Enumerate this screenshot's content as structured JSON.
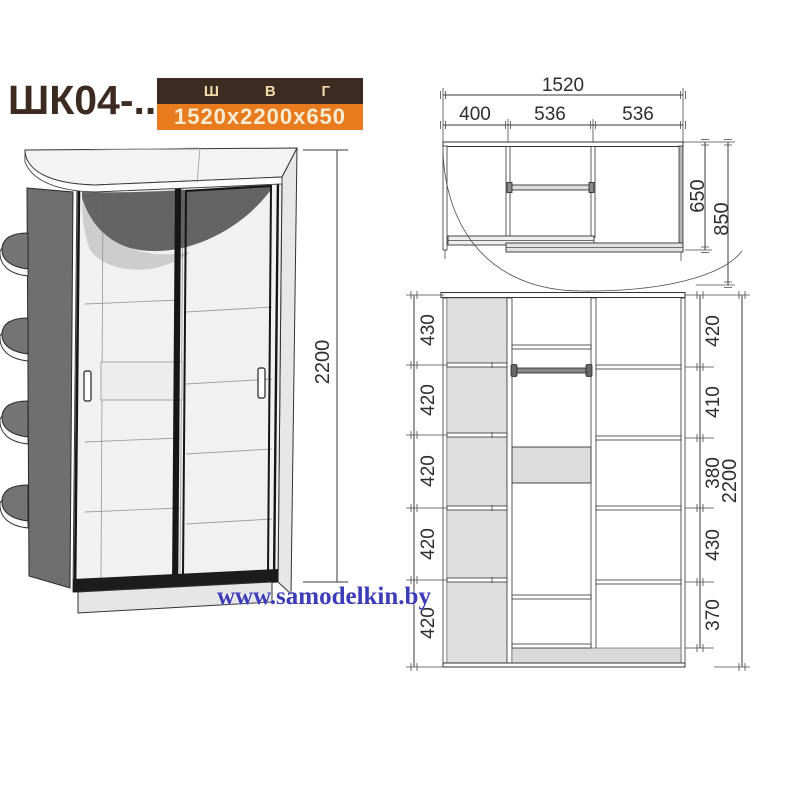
{
  "header": {
    "model": "ШК04-..",
    "spec_columns": [
      "Ш",
      "В",
      "Г"
    ],
    "spec_value": "1520x2200x650"
  },
  "colors": {
    "brown": "#3d2b22",
    "orange": "#e87b1d",
    "cream": "#eedcab",
    "blue": "#3c3cb8"
  },
  "watermark": "www.samodelkin.by",
  "views": {
    "perspective": {
      "height_total": "2200"
    },
    "plan": {
      "width_total": "1520",
      "width_segments": [
        "400",
        "536",
        "536"
      ],
      "depth_body": "650",
      "depth_overall": "850"
    },
    "front": {
      "left_heights": [
        "430",
        "420",
        "420",
        "420",
        "420"
      ],
      "right_heights": [
        "420",
        "410",
        "380",
        "430",
        "370"
      ],
      "height_total": "2200"
    }
  }
}
